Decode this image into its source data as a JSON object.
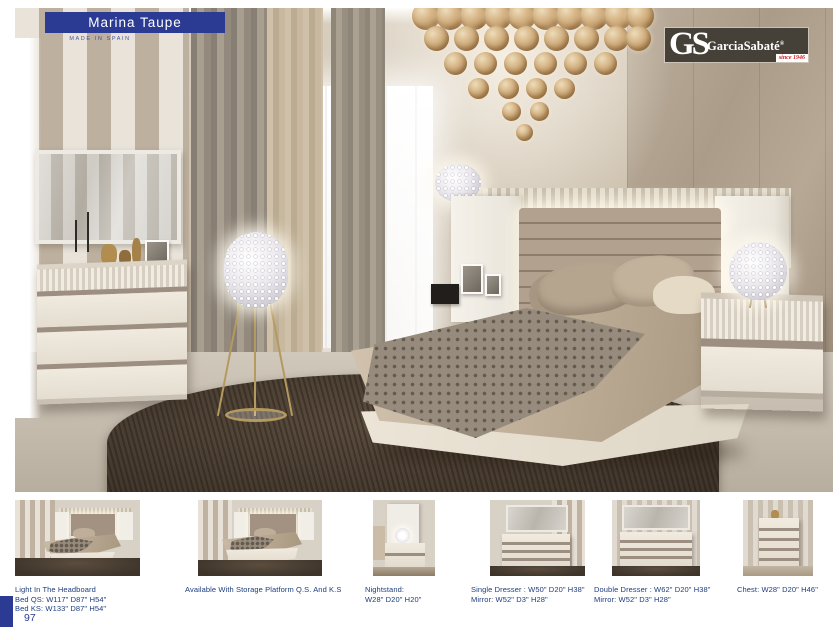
{
  "page": {
    "title": "Marina Taupe",
    "subtitle": "MADE IN SPAIN",
    "page_number": "97"
  },
  "brand": {
    "initials": "GS",
    "name": "GarciaSabaté",
    "registered": "®",
    "tagline": "since 1946"
  },
  "products": [
    {
      "id": "bed-headboard",
      "caption_lines": [
        "Light In The Headboard",
        "Bed QS: W117\" D87\" H54\"",
        "Bed KS: W133\" D87\" H54\""
      ]
    },
    {
      "id": "bed-storage",
      "caption_lines": [
        "Available With Storage Platform Q.S. And K.S"
      ]
    },
    {
      "id": "nightstand",
      "caption_lines": [
        "Nightstand:",
        "W28\" D20\" H20\""
      ]
    },
    {
      "id": "single-dresser",
      "caption_lines": [
        "Single Dresser : W50\" D20\" H38\"",
        "Mirror: W52\" D3\" H28\""
      ]
    },
    {
      "id": "double-dresser",
      "caption_lines": [
        "Double Dresser : W62\" D20\" H38\"",
        "Mirror: W52\" D3\" H28\""
      ]
    },
    {
      "id": "chest",
      "caption_lines": [
        "Chest: W28\" D20\" H46\""
      ]
    }
  ],
  "colors": {
    "navy": "#2b3a92",
    "caption_text": "#1d3c7d",
    "logo_background": "#454038",
    "logo_red": "#cc2127"
  }
}
